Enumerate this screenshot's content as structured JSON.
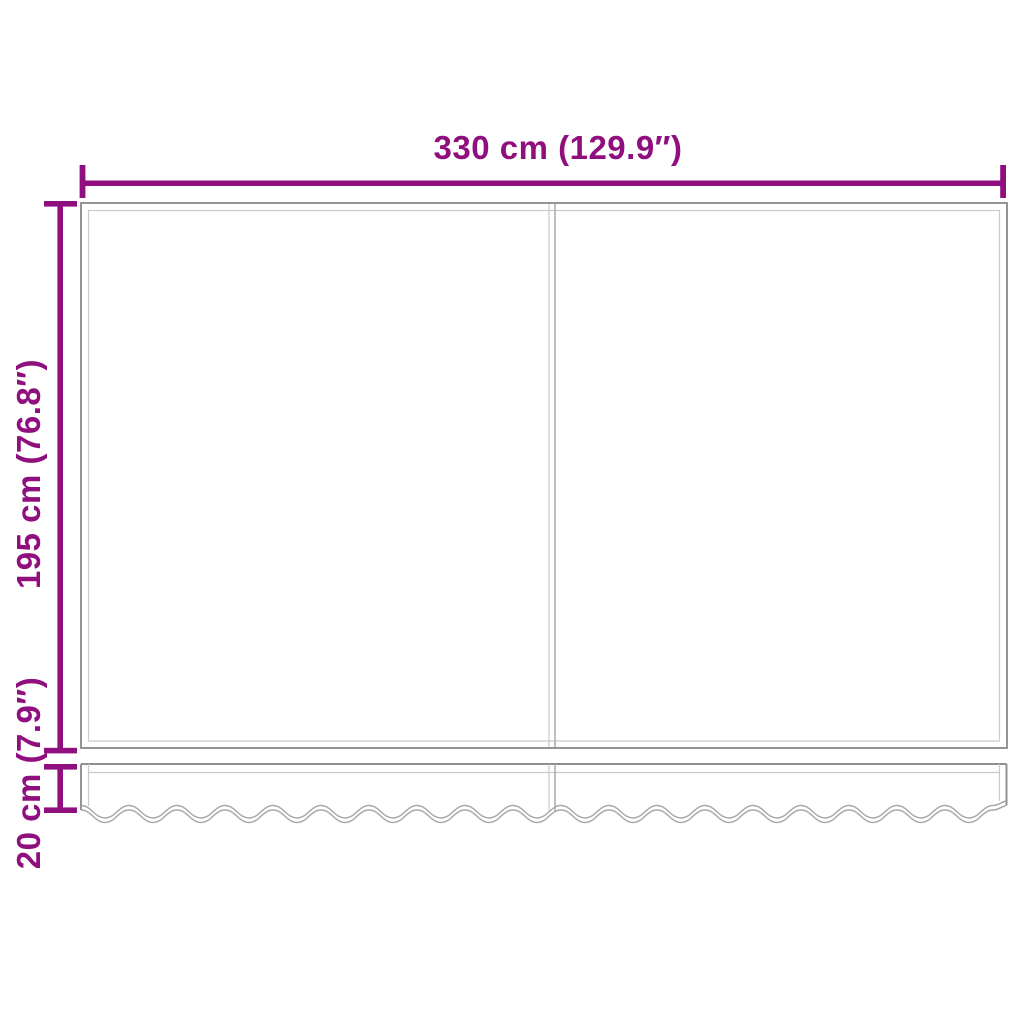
{
  "diagram": {
    "type": "product-dimension-diagram",
    "subject": "replacement awning fabric with wavy valance",
    "panel_count": 2,
    "labels": {
      "width": "330 cm (129.9″)",
      "height": "195 cm (76.8″)",
      "valance_height": "20 cm (7.9″)"
    },
    "colors": {
      "accent": "#900f7f",
      "outline_dark": "#8e8e8e",
      "outline_mid": "#a8a8a8",
      "outline_light": "#c9c9c9",
      "background": "#ffffff"
    }
  }
}
